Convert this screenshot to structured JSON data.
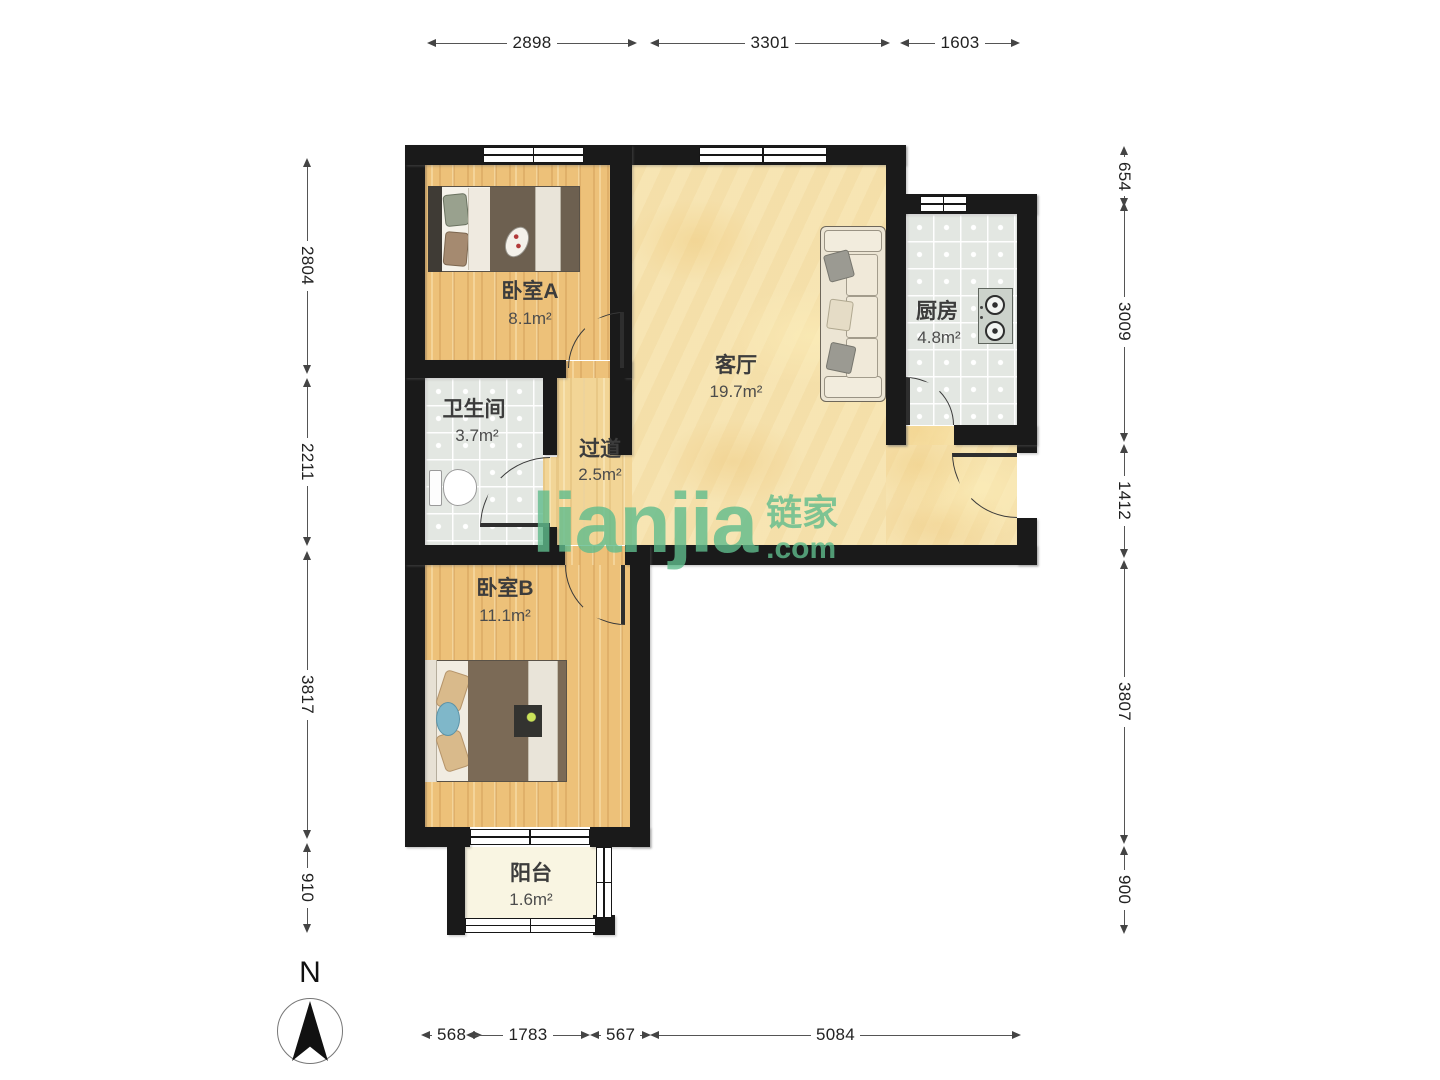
{
  "branding": {
    "logo_text": "lianjia",
    "logo_cjk": "链家",
    "logo_suffix": ".com"
  },
  "compass": {
    "north_label": "N"
  },
  "rooms": [
    {
      "name": "卧室A",
      "area": "8.1m²"
    },
    {
      "name": "卫生间",
      "area": "3.7m²"
    },
    {
      "name": "过道",
      "area": "2.5m²"
    },
    {
      "name": "客厅",
      "area": "19.7m²"
    },
    {
      "name": "厨房",
      "area": "4.8m²"
    },
    {
      "name": "卧室B",
      "area": "11.1m²"
    },
    {
      "name": "阳台",
      "area": "1.6m²"
    }
  ],
  "dimensions_mm": {
    "top": [
      "2898",
      "3301",
      "1603"
    ],
    "bottom": [
      "568",
      "1783",
      "567",
      "5084"
    ],
    "left": [
      "2804",
      "2211",
      "3817",
      "910"
    ],
    "right": [
      "654",
      "3009",
      "1412",
      "3807",
      "900"
    ]
  },
  "colors": {
    "wall": "#1a1a1a",
    "wood_floor": "#edc179",
    "stone_floor": "#f6e3b0",
    "tile_floor": "#e3e7e2",
    "balcony_floor": "#f9f5e2",
    "brand_green": "#5cb98b"
  }
}
